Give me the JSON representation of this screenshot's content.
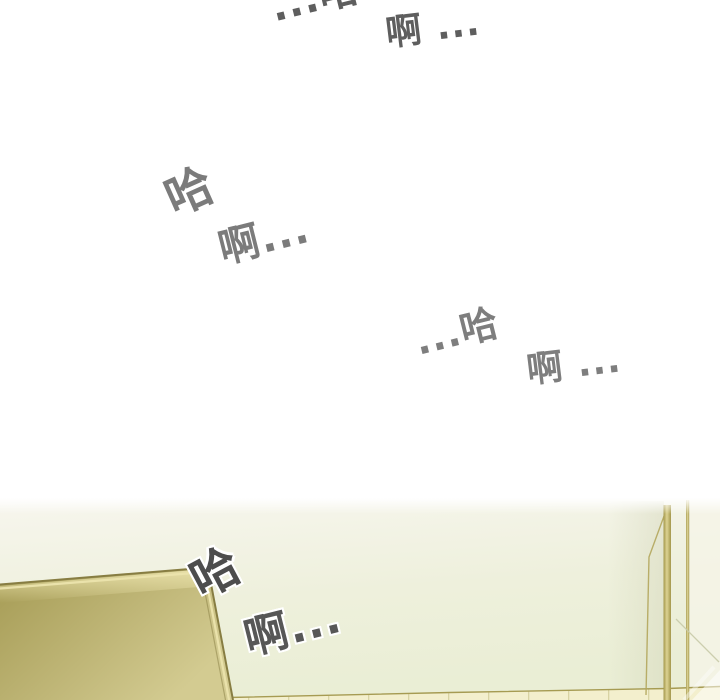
{
  "sfx": [
    {
      "id": "top-ha",
      "text": "...哈",
      "color": "#5e5e5e"
    },
    {
      "id": "top-ah",
      "text": "啊 ...",
      "color": "#5e5e5e"
    },
    {
      "id": "mid-left-ha",
      "text": "哈",
      "color": "#7b7b7b"
    },
    {
      "id": "mid-left-ah",
      "text": "啊...",
      "color": "#7b7b7b"
    },
    {
      "id": "mid-right-ha",
      "text": "...哈",
      "color": "#7e7e7e"
    },
    {
      "id": "mid-right-ah",
      "text": "啊 ...",
      "color": "#7e7e7e"
    },
    {
      "id": "panel-ha",
      "text": "哈",
      "color": "#4d4d4d"
    },
    {
      "id": "panel-ah",
      "text": "啊...",
      "color": "#575757"
    }
  ],
  "colors": {
    "page_background": "#ffffff",
    "wall_top": "#f7f6ee",
    "wall_mid": "#eef0dc",
    "wall_bottom": "#eaeed5",
    "wall_right_strip": "#f6f4e8",
    "panel_dark": "#a89e58",
    "panel_mid": "#bfb677",
    "panel_light": "#d3cb91",
    "panel_highlight": "#ece4ad",
    "frame_dark": "#877d42",
    "gold_edge_dark": "#a3974b",
    "gold_edge_light": "#ddd393",
    "glass_edge": "#b2a65c",
    "tile": "#f3efcd",
    "tile_grout": "#d8d3a3",
    "ledge_line": "#a69b52",
    "corner_shadow": "#c8cba9",
    "sfx_outline": "#ffffff"
  }
}
